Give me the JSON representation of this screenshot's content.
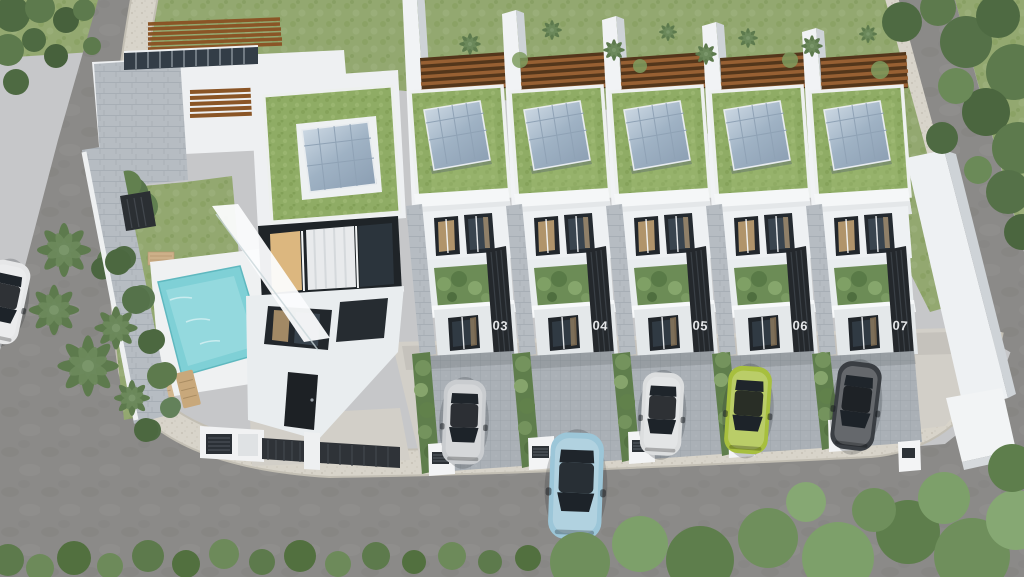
{
  "scene": {
    "description": "Aerial 3D architectural rendering of a modern eco-friendly townhouse row, units 03 to 07, with planted green roofs, tilted rooftop solar panels, timber pergola slats, a corner villa with swimming pool and sun loungers, paver driveways with parked cars, palm trees and tree-lined streets.",
    "units": [
      {
        "label": "03"
      },
      {
        "label": "04"
      },
      {
        "label": "05"
      },
      {
        "label": "06"
      },
      {
        "label": "07"
      }
    ],
    "colors": {
      "lawn_green": "#93a870",
      "green_roof": "#8fac65",
      "foliage_dark": "#4e6a42",
      "palm_green": "#5d7a4d",
      "hedge_green": "#6c8c56",
      "asphalt": "#8b8a88",
      "sidewalk": "#d8d4ca",
      "paver_grey": "#aab0b6",
      "apron": "#d2cfc8",
      "building_white": "#eef1f3",
      "building_shade": "#ced3d7",
      "stone_grey": "#b6bcc2",
      "timber_brown": "#8a5526",
      "solar_blue": "#aebfd0",
      "dark_cladding": "#24282c",
      "pool_teal": "#7fd0d6",
      "window_glass": "#22272c",
      "window_glow": "#d8b37e",
      "number_text": "#e4e6e8"
    },
    "cars": [
      {
        "name": "white sedan on left street",
        "color": "#e6e7e8"
      },
      {
        "name": "silver sedan in driveway 03",
        "color": "#c9cccf"
      },
      {
        "name": "light-blue sedan on front street",
        "color": "#9cc6d8"
      },
      {
        "name": "white sedan in driveway 05",
        "color": "#dcdedf"
      },
      {
        "name": "lime-green sedan in driveway 06",
        "color": "#a7bf3e"
      },
      {
        "name": "dark-grey sedan in driveway 07",
        "color": "#3a3e43"
      }
    ]
  }
}
